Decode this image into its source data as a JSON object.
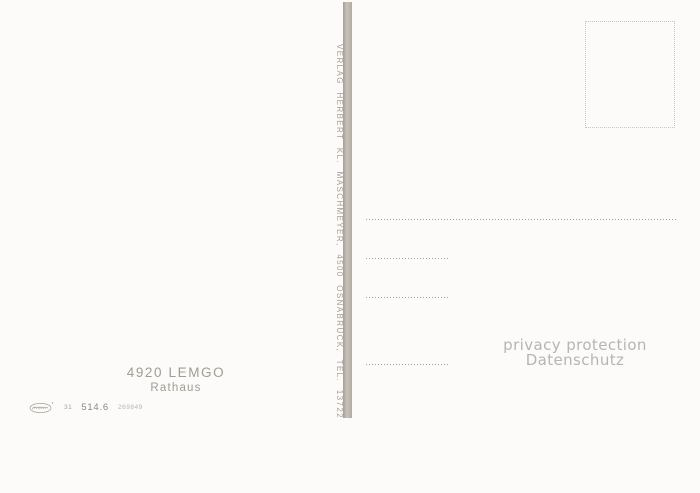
{
  "postcard": {
    "publisher_line": "VERLAG HERBERT KL. MASCHMEYER, 4500 OSNABRÜCK, TEL. 13722",
    "caption": {
      "line1": "4920 LEMGO",
      "line2": "Rathaus"
    },
    "imprint": {
      "logo_icon": "printer-script-logo",
      "prefix": "31",
      "number": "514.6",
      "code": "269849"
    },
    "watermark": {
      "line1": "privacy protection",
      "line2": "Datenschutz"
    },
    "colors": {
      "background": "#fcfbf9",
      "divider": "#b3aaa3",
      "publisher_text": "#a49e96",
      "caption_text": "#a29c93",
      "address_rule": "#9f9d9a",
      "stamp_border": "#c6c4c0",
      "watermark_text": "#b5b5b5"
    }
  }
}
